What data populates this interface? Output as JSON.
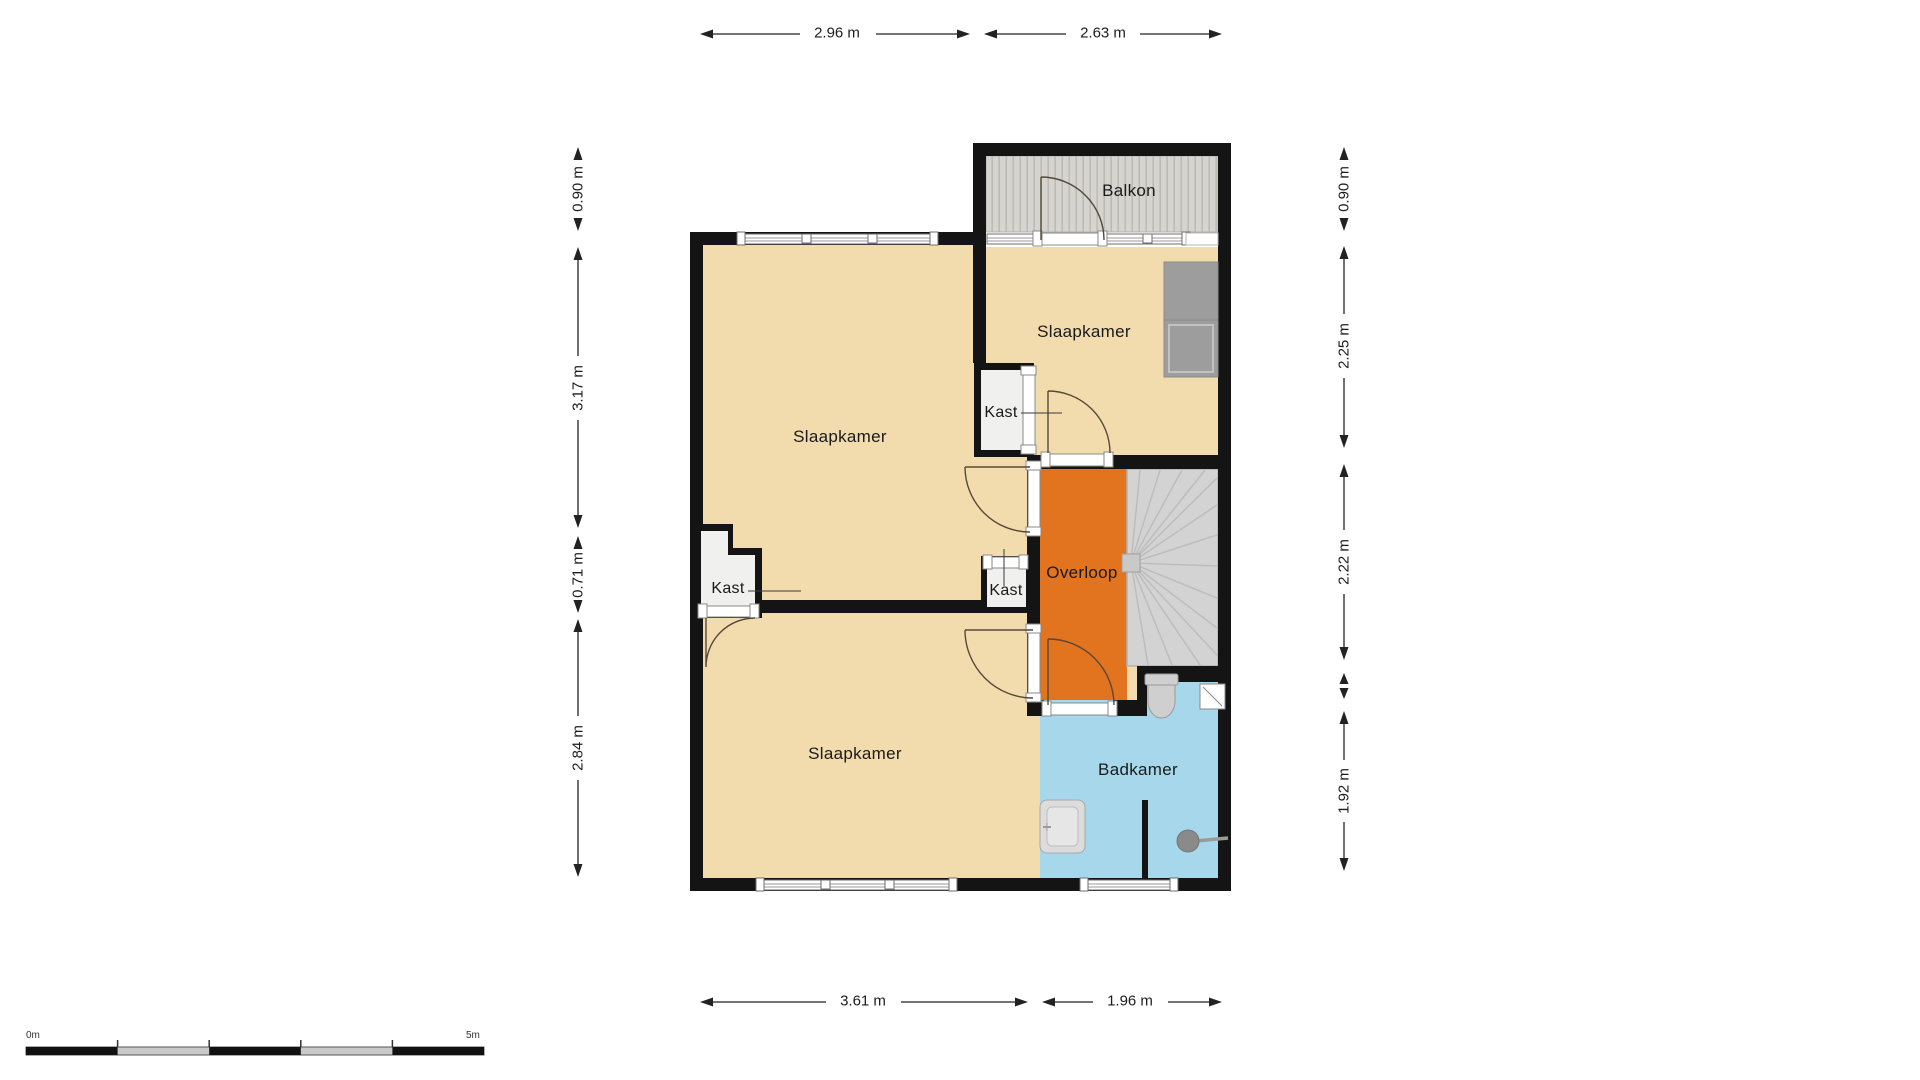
{
  "plan": {
    "rooms": {
      "balkon": "Balkon",
      "bedroom_top_right": "Slaapkamer",
      "bedroom_main": "Slaapkamer",
      "bedroom_bottom": "Slaapkamer",
      "landing": "Overloop",
      "bathroom": "Badkamer",
      "closet_top": "Kast",
      "closet_left": "Kast",
      "closet_center": "Kast"
    },
    "dimensions": {
      "top": [
        "2.96 m",
        "2.63 m"
      ],
      "bottom": [
        "3.61 m",
        "1.96 m"
      ],
      "left": [
        "0.90 m",
        "3.17 m",
        "0.71 m",
        "2.84 m"
      ],
      "right": [
        "0.90 m",
        "2.25 m",
        "2.22 m",
        "1.92 m"
      ]
    },
    "scale_bar": {
      "start": "0m",
      "end": "5m"
    },
    "colors": {
      "floor_tan": "#f2dcae",
      "landing_orange": "#e2731f",
      "bathroom_blue": "#a6d7ea",
      "wall_black": "#141414",
      "balcony_gray": "#d5d4cf",
      "stairs_gray": "#d3d3d3"
    },
    "fixtures": [
      "stairs",
      "toilet",
      "corner-basin",
      "washbasin",
      "shower-head",
      "wardrobe",
      "partition-wall"
    ]
  }
}
